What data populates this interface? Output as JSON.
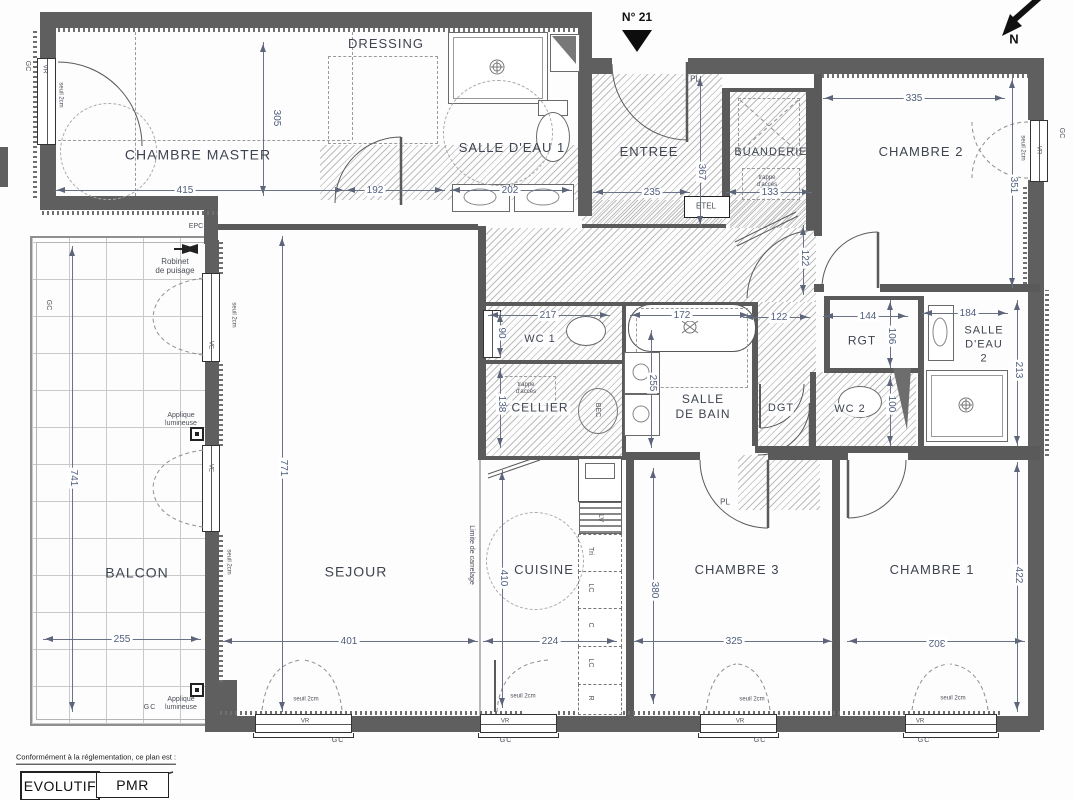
{
  "plan": {
    "number": "N° 21",
    "north": "N"
  },
  "rooms": {
    "chambre_master": "CHAMBRE MASTER",
    "dressing": "DRESSING",
    "salle_eau_1": "SALLE D'EAU 1",
    "entree": "ENTREE",
    "buanderie": "BUANDERIE",
    "chambre_2": "CHAMBRE 2",
    "balcon": "BALCON",
    "sejour": "SEJOUR",
    "cuisine": "CUISINE",
    "cellier": "CELLIER",
    "wc_1": "WC 1",
    "salle_de_bain": "SALLE\nDE BAIN",
    "dgt": "DGT",
    "rgt": "RGT",
    "wc_2": "WC 2",
    "salle_eau_2": "SALLE\nD'EAU\n2",
    "chambre_3": "CHAMBRE 3",
    "chambre_1": "CHAMBRE 1"
  },
  "dims": {
    "master_w": "415",
    "master_h": "305",
    "sde1_l": "192",
    "sde1_w": "202",
    "entree_h": "367",
    "entree_w": "235",
    "buanderie_w": "133",
    "ch2_w": "335",
    "ch2_h": "351",
    "balcon_h": "741",
    "balcon_w": "255",
    "sejour_h": "771",
    "sejour_w": "401",
    "cuisine_h": "410",
    "cuisine_w": "224",
    "wc1_w": "217",
    "wc1_h": "90",
    "baignoire_w": "172",
    "sdb_h": "255",
    "cellier_h": "138",
    "dgt_w": "122",
    "couloir_h": "122",
    "rgt_w": "144",
    "rgt_h": "106",
    "sde2_w": "184",
    "sde2_h": "213",
    "wc2_h": "100",
    "ch3_h": "380",
    "ch3_w": "325",
    "ch1_w": "302",
    "ch1_h": "422"
  },
  "labels": {
    "gc": "GC",
    "vr": "VR",
    "ve": "VE",
    "pl": "PL",
    "etel": "ETEL",
    "epc": "EPC",
    "seuil": "seuil 2cm",
    "robinet": "Robinet\nde puisage",
    "applique": "Applique\nlumineuse",
    "limite": "Limite de carrelage",
    "trappe": "trappe\nd'accès",
    "bec": "BEC",
    "lv": "LV",
    "tri": "Tri",
    "lc": "LC",
    "c": "C",
    "r": "R"
  },
  "footer": {
    "note": "Conformément à la réglementation, ce plan est :",
    "evolutif": "EVOLUTIF",
    "pmr": "PMR"
  }
}
